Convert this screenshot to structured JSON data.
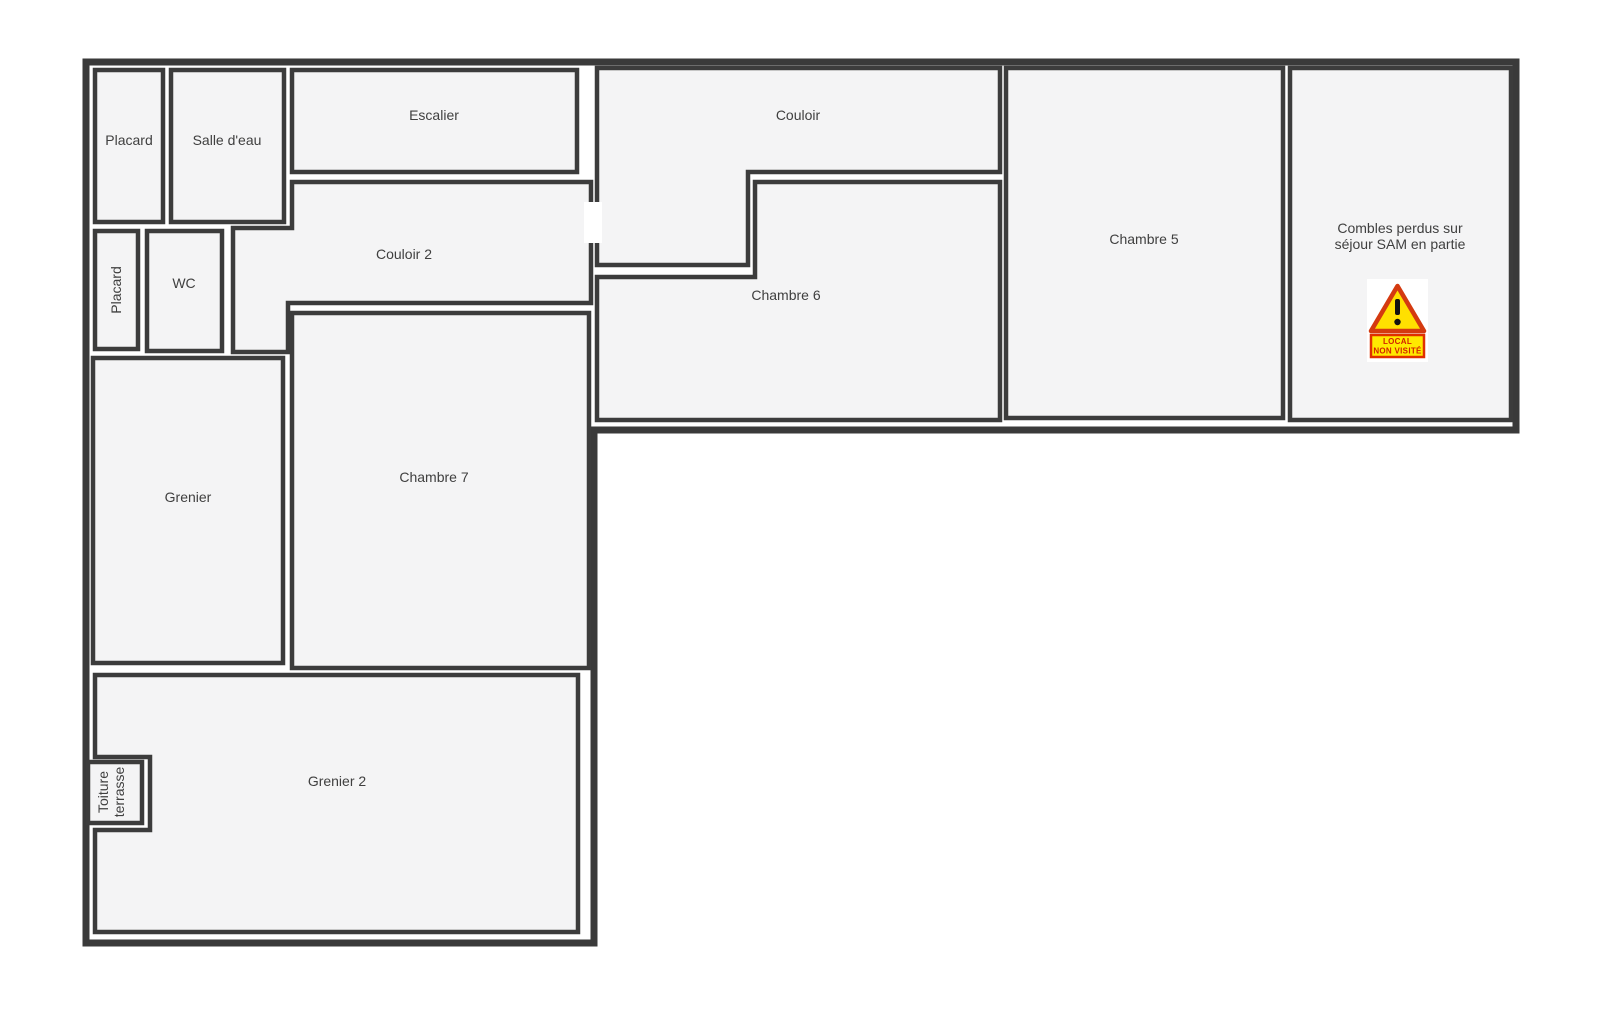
{
  "floorplan": {
    "rooms": {
      "placard_top": {
        "label": "Placard"
      },
      "salle_deau": {
        "label": "Salle d'eau"
      },
      "escalier": {
        "label": "Escalier"
      },
      "couloir_2": {
        "label": "Couloir 2"
      },
      "placard_side": {
        "label": "Placard"
      },
      "wc": {
        "label": "WC"
      },
      "grenier": {
        "label": "Grenier"
      },
      "chambre_7": {
        "label": "Chambre 7"
      },
      "grenier_2": {
        "label": "Grenier 2"
      },
      "toiture_terrasse": {
        "label_line1": "Toiture",
        "label_line2": "terrasse"
      },
      "couloir": {
        "label": "Couloir"
      },
      "chambre_6": {
        "label": "Chambre 6"
      },
      "chambre_5": {
        "label": "Chambre 5"
      },
      "combles": {
        "label_line1": "Combles perdus sur",
        "label_line2": "séjour SAM en partie"
      }
    },
    "warning_sign": {
      "line1": "LOCAL",
      "line2": "NON VISITÉ"
    },
    "colors": {
      "wall": "#3a3a3a",
      "room_border": "#3c3c3c",
      "room_fill": "#f4f4f5",
      "label_text": "#3f3f3f",
      "warning_red": "#d43a10",
      "warning_yellow": "#ffe000",
      "warning_sign_text": "#d32300",
      "background": "#ffffff"
    }
  }
}
